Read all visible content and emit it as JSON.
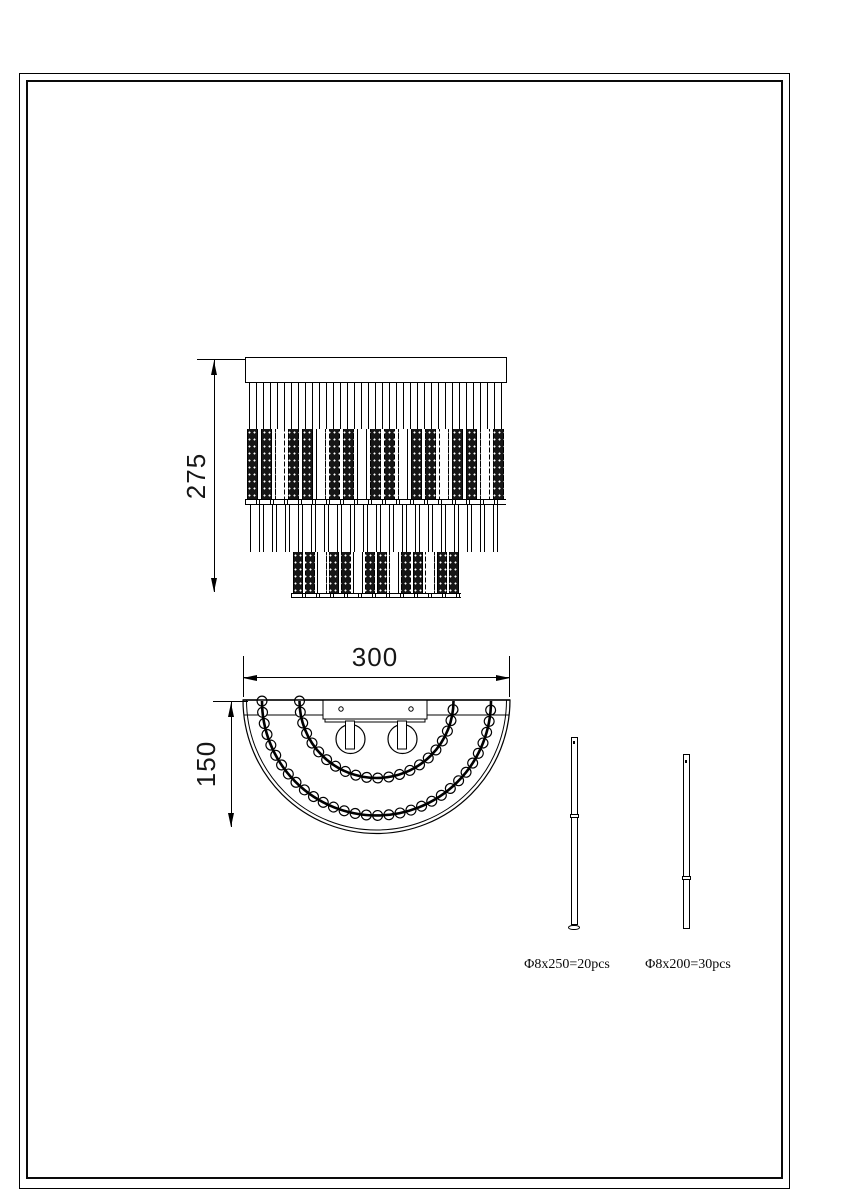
{
  "colors": {
    "line": "#000000",
    "paper": "#ffffff"
  },
  "drawing": {
    "front_view": {
      "height_dim": "275"
    },
    "plan_view": {
      "width_dim": "300",
      "depth_dim": "150"
    },
    "parts": [
      {
        "label": "Φ8x250=20pcs"
      },
      {
        "label": "Φ8x200=30pcs"
      }
    ]
  }
}
